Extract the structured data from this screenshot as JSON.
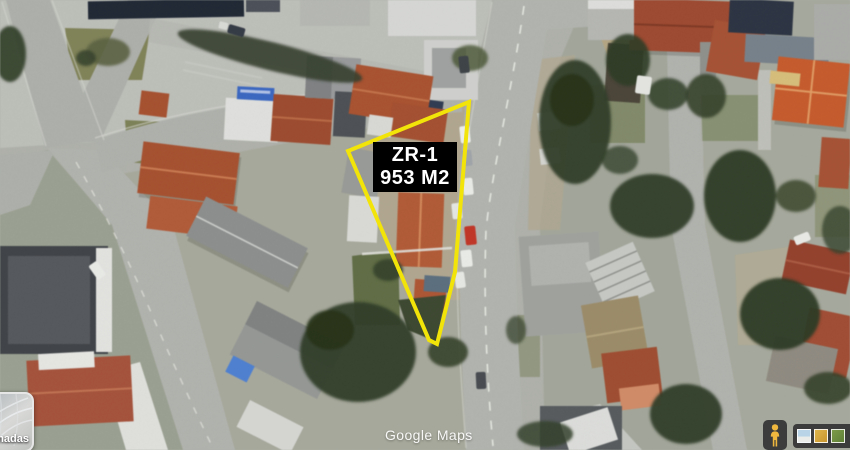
{
  "map": {
    "parcel": {
      "zone_label": "ZR-1",
      "area_label": "953 M2",
      "outline_color": "#f2e409",
      "label_bg": "#000000",
      "label_text_color": "#ffffff"
    },
    "watermark": "Google Maps"
  },
  "controls": {
    "layers": {
      "visible_label": "amadas"
    },
    "pegman": {
      "icon": "pegman-icon",
      "color": "#f0b73f"
    },
    "imagery_thumbnails": {
      "items": [
        {
          "name": "thumbnail-blue",
          "color": "#b8d4e6"
        },
        {
          "name": "thumbnail-yellow",
          "color": "#d2a53e"
        },
        {
          "name": "thumbnail-green",
          "color": "#6f8f3f"
        }
      ]
    }
  }
}
